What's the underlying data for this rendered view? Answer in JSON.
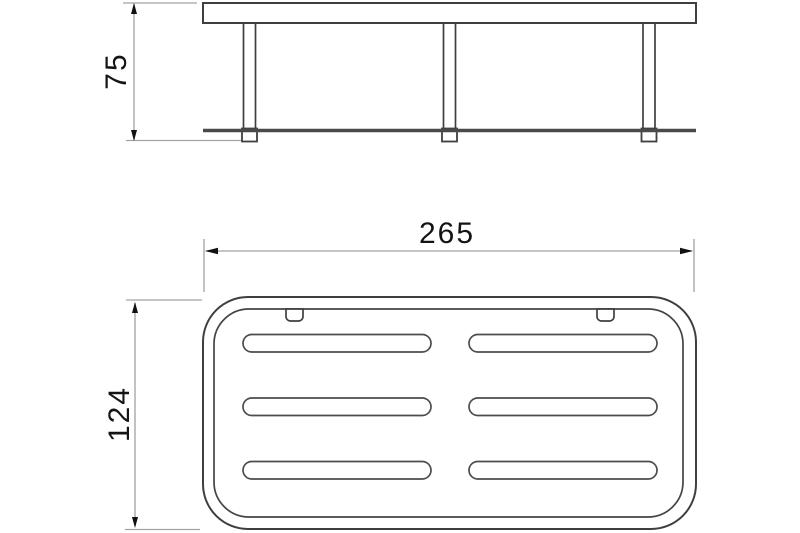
{
  "page": {
    "background": "#ffffff",
    "kind": "technical-dimension-drawing",
    "subject": "wall-mounted rectangular shelf basket"
  },
  "drawing": {
    "views": {
      "side_view": {
        "name": "side-elevation",
        "label_height_mm": "75",
        "legs": 3
      },
      "plan_view": {
        "name": "top-plan",
        "label_width_mm": "265",
        "label_depth_mm": "124",
        "slot_rows": 3,
        "slot_columns": 2,
        "mount_tabs": 2
      }
    },
    "colors": {
      "background": "#ffffff",
      "outline": "#3f3f3f",
      "rail": "#4a4a4a",
      "dimension_line": "#a2a2a2",
      "arrow_and_text": "#141414"
    }
  }
}
